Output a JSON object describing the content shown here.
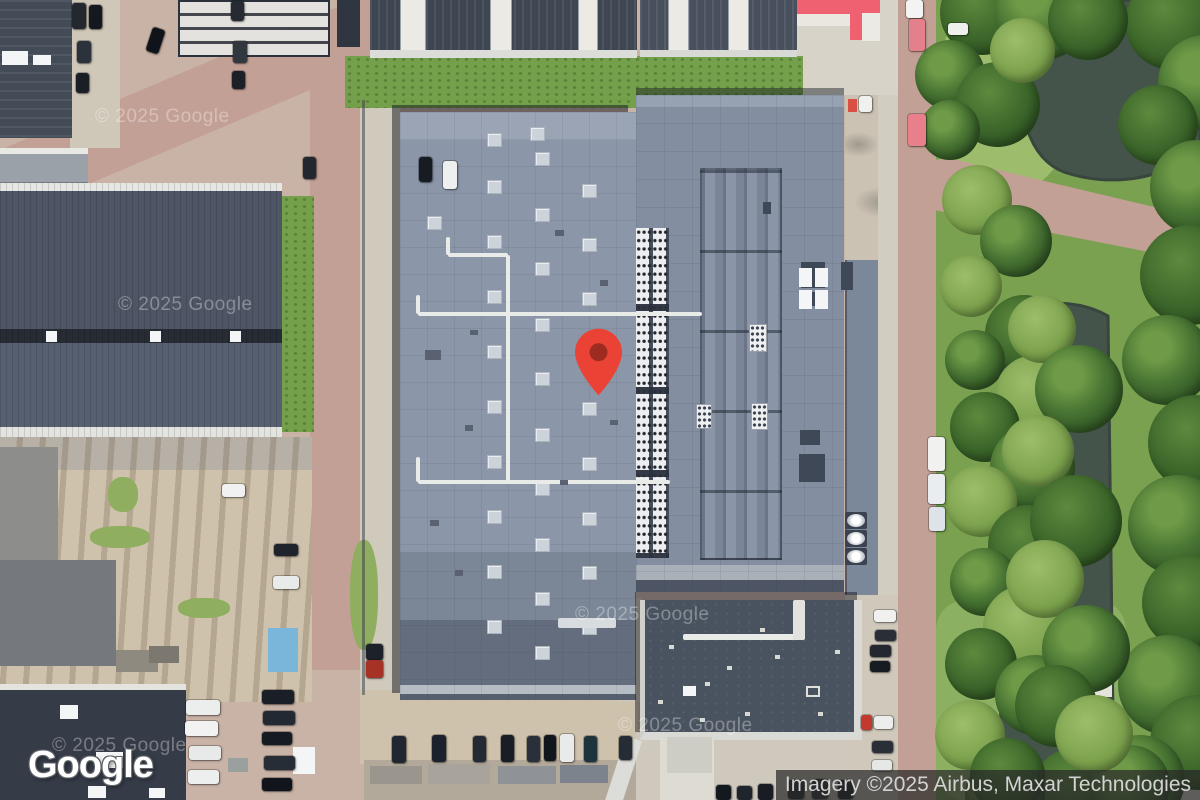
{
  "map": {
    "view": "satellite",
    "logo": "Google",
    "attribution": "Imagery ©2025 Airbus, Maxar Technologies",
    "watermark": "© 2025 Google",
    "watermarks": [
      [
        95,
        106
      ],
      [
        118,
        294
      ],
      [
        575,
        604
      ],
      [
        618,
        715
      ],
      [
        52,
        735
      ]
    ],
    "marker": {
      "name": "location-pin",
      "color": "#EA4335",
      "dot_color": "#9E2B20",
      "x": 598,
      "y": 396
    }
  },
  "colors": {
    "pin_red": "#EA4335",
    "water": "#45544b",
    "grass": "#79a150",
    "road": "#c3a095",
    "main_roof": "#8b96a8",
    "attribution_bg": "rgba(40,40,40,0.72)"
  },
  "scene": {
    "trees": [
      [
        1125,
        -25,
        95,
        1
      ],
      [
        1158,
        35,
        95,
        0
      ],
      [
        1118,
        85,
        80,
        1
      ],
      [
        1150,
        140,
        95,
        0
      ],
      [
        1140,
        225,
        100,
        1
      ],
      [
        1122,
        315,
        90,
        0
      ],
      [
        1148,
        395,
        95,
        1
      ],
      [
        1128,
        475,
        100,
        0
      ],
      [
        1142,
        555,
        95,
        1
      ],
      [
        1118,
        635,
        100,
        0
      ],
      [
        1150,
        695,
        95,
        1
      ],
      [
        1095,
        735,
        90,
        0
      ],
      [
        1032,
        748,
        85,
        1
      ],
      [
        965,
        755,
        80,
        0
      ],
      [
        935,
        700,
        70,
        2
      ],
      [
        970,
        738,
        75,
        1
      ],
      [
        1090,
        745,
        80,
        0
      ],
      [
        940,
        -30,
        85,
        1
      ],
      [
        995,
        -35,
        95,
        0
      ],
      [
        1048,
        -20,
        80,
        1
      ],
      [
        915,
        40,
        70,
        0
      ],
      [
        955,
        62,
        85,
        1
      ],
      [
        920,
        100,
        60,
        0
      ],
      [
        990,
        18,
        65,
        2
      ],
      [
        942,
        165,
        70,
        2
      ],
      [
        980,
        205,
        72,
        0
      ],
      [
        940,
        255,
        62,
        2
      ],
      [
        985,
        295,
        78,
        1
      ],
      [
        945,
        330,
        60,
        0
      ],
      [
        995,
        355,
        80,
        2
      ],
      [
        950,
        392,
        70,
        1
      ],
      [
        990,
        425,
        85,
        0
      ],
      [
        945,
        465,
        72,
        2
      ],
      [
        988,
        505,
        80,
        1
      ],
      [
        950,
        548,
        68,
        0
      ],
      [
        983,
        585,
        85,
        2
      ],
      [
        945,
        628,
        72,
        1
      ],
      [
        995,
        655,
        80,
        0
      ],
      [
        1008,
        295,
        68,
        2
      ],
      [
        1035,
        345,
        88,
        0
      ],
      [
        1002,
        415,
        72,
        2
      ],
      [
        1030,
        475,
        92,
        1
      ],
      [
        1006,
        540,
        78,
        2
      ],
      [
        1042,
        605,
        88,
        0
      ],
      [
        1015,
        665,
        82,
        1
      ],
      [
        1055,
        695,
        78,
        2
      ]
    ],
    "cars": [
      [
        72,
        3,
        14,
        26,
        "#23272e"
      ],
      [
        89,
        5,
        13,
        24,
        "#15181e"
      ],
      [
        77,
        41,
        14,
        22,
        "#2c323b"
      ],
      [
        76,
        73,
        13,
        20,
        "#1a1e25"
      ],
      [
        149,
        28,
        13,
        25,
        "#101319",
        18
      ],
      [
        231,
        1,
        13,
        20,
        "#262b33"
      ],
      [
        233,
        41,
        14,
        22,
        "#31373f"
      ],
      [
        232,
        71,
        13,
        18,
        "#1b2026"
      ],
      [
        303,
        157,
        13,
        22,
        "#23282f"
      ],
      [
        419,
        157,
        13,
        25,
        "#171b22"
      ],
      [
        443,
        161,
        14,
        28,
        "#eef0ef"
      ],
      [
        392,
        736,
        14,
        27,
        "#202730"
      ],
      [
        432,
        735,
        14,
        27,
        "#1c222b"
      ],
      [
        473,
        736,
        13,
        26,
        "#242a34"
      ],
      [
        501,
        735,
        13,
        27,
        "#181d26"
      ],
      [
        527,
        736,
        13,
        26,
        "#2a303a"
      ],
      [
        544,
        735,
        12,
        26,
        "#11151c"
      ],
      [
        560,
        734,
        14,
        28,
        "#e9ebea"
      ],
      [
        584,
        736,
        13,
        26,
        "#1e343c"
      ],
      [
        619,
        736,
        13,
        24,
        "#262c35"
      ],
      [
        186,
        700,
        34,
        15,
        "#eceeed"
      ],
      [
        185,
        721,
        33,
        15,
        "#f1f2f1"
      ],
      [
        189,
        746,
        32,
        14,
        "#e8eaea"
      ],
      [
        188,
        770,
        31,
        14,
        "#edeeee"
      ],
      [
        262,
        690,
        32,
        14,
        "#1a1f27"
      ],
      [
        263,
        711,
        32,
        14,
        "#232933"
      ],
      [
        262,
        732,
        30,
        13,
        "#161a21"
      ],
      [
        264,
        756,
        31,
        14,
        "#272d37"
      ],
      [
        262,
        778,
        30,
        13,
        "#11151b"
      ],
      [
        222,
        484,
        23,
        13,
        "#f0f1f0"
      ],
      [
        274,
        544,
        24,
        12,
        "#1e232c"
      ],
      [
        273,
        576,
        26,
        13,
        "#e9eaea"
      ],
      [
        870,
        645,
        21,
        12,
        "#23272f"
      ],
      [
        870,
        661,
        20,
        11,
        "#171b22"
      ],
      [
        861,
        715,
        11,
        15,
        "#c2392d"
      ],
      [
        874,
        716,
        19,
        13,
        "#ecedec"
      ],
      [
        872,
        741,
        21,
        12,
        "#2a2f37"
      ],
      [
        872,
        760,
        20,
        11,
        "#e6e8e7"
      ],
      [
        874,
        610,
        22,
        12,
        "#f0f1ef"
      ],
      [
        875,
        630,
        21,
        11,
        "#292e37"
      ],
      [
        906,
        0,
        17,
        18,
        "#f2f3f2"
      ],
      [
        909,
        19,
        16,
        32,
        "#e4808c"
      ],
      [
        908,
        114,
        18,
        32,
        "#e87f8b"
      ],
      [
        948,
        23,
        20,
        12,
        "#eff0ee"
      ],
      [
        928,
        437,
        17,
        34,
        "#f1f2f0"
      ],
      [
        928,
        474,
        17,
        30,
        "#e9edf0"
      ],
      [
        929,
        507,
        16,
        24,
        "#dde3e8"
      ],
      [
        859,
        96,
        13,
        16,
        "#f0f1ef"
      ],
      [
        716,
        785,
        15,
        15,
        "#14181f"
      ],
      [
        737,
        786,
        15,
        14,
        "#20252d"
      ],
      [
        758,
        784,
        15,
        16,
        "#181c24"
      ],
      [
        788,
        780,
        16,
        19,
        "#1d222a"
      ],
      [
        812,
        779,
        16,
        20,
        "#252b34"
      ],
      [
        838,
        780,
        15,
        19,
        "#14181f"
      ],
      [
        366,
        644,
        17,
        16,
        "#1d222a"
      ],
      [
        366,
        660,
        17,
        18,
        "#a63226"
      ]
    ],
    "skylights": [
      [
        487,
        133
      ],
      [
        530,
        127
      ],
      [
        535,
        152
      ],
      [
        487,
        180
      ],
      [
        582,
        184
      ],
      [
        535,
        208
      ],
      [
        427,
        216
      ],
      [
        487,
        235
      ],
      [
        582,
        238
      ],
      [
        535,
        262
      ],
      [
        487,
        290
      ],
      [
        582,
        292
      ],
      [
        535,
        318
      ],
      [
        487,
        345
      ],
      [
        582,
        347
      ],
      [
        535,
        372
      ],
      [
        487,
        400
      ],
      [
        582,
        402
      ],
      [
        535,
        428
      ],
      [
        487,
        455
      ],
      [
        582,
        457
      ],
      [
        535,
        482
      ],
      [
        487,
        510
      ],
      [
        582,
        512
      ],
      [
        535,
        538
      ],
      [
        487,
        565
      ],
      [
        582,
        566
      ],
      [
        535,
        592
      ],
      [
        487,
        620
      ],
      [
        582,
        621
      ],
      [
        535,
        646
      ]
    ],
    "sprites": [
      [
        "pipe",
        418,
        312,
        284,
        4
      ],
      [
        "pipe",
        506,
        255,
        4,
        60
      ],
      [
        "pipe",
        448,
        253,
        60,
        4
      ],
      [
        "pipe",
        446,
        237,
        4,
        18
      ],
      [
        "pipe",
        418,
        480,
        252,
        4
      ],
      [
        "pipe",
        506,
        314,
        4,
        168
      ],
      [
        "pipe",
        416,
        295,
        4,
        19
      ],
      [
        "pipe",
        416,
        457,
        4,
        25
      ],
      [
        "pipe",
        558,
        618,
        58,
        10,
        "#d9dcdf"
      ],
      [
        "pipe",
        683,
        634,
        114,
        6
      ],
      [
        "pipe",
        793,
        600,
        12,
        40,
        "#e2e3df"
      ],
      [
        "panel",
        801,
        262,
        24,
        26
      ],
      [
        "panel",
        801,
        292,
        24,
        14
      ],
      [
        "panel",
        799,
        454,
        26,
        28
      ],
      [
        "panel",
        841,
        262,
        12,
        28
      ],
      [
        "panel",
        800,
        430,
        20,
        15
      ],
      [
        "panel",
        763,
        202,
        8,
        12
      ],
      [
        "hvacbox",
        749,
        324,
        18,
        28
      ],
      [
        "hvacbox",
        696,
        404,
        16,
        25
      ],
      [
        "hvacbox",
        751,
        403,
        17,
        27
      ],
      [
        "fan",
        845,
        512,
        22,
        17
      ],
      [
        "fan",
        845,
        530,
        22,
        17
      ],
      [
        "fan",
        845,
        548,
        22,
        17
      ],
      [
        "slb",
        799,
        268,
        13,
        19
      ],
      [
        "slb",
        815,
        268,
        13,
        19
      ],
      [
        "slb",
        799,
        290,
        13,
        19
      ],
      [
        "slb",
        815,
        290,
        13,
        19
      ],
      [
        "slb",
        46,
        331,
        11,
        11
      ],
      [
        "slb",
        150,
        331,
        11,
        11
      ],
      [
        "slb",
        230,
        331,
        11,
        11
      ],
      [
        "slb",
        60,
        705,
        18,
        14
      ],
      [
        "slb",
        96,
        752,
        27,
        16
      ],
      [
        "slb",
        88,
        786,
        18,
        12
      ],
      [
        "slb",
        149,
        788,
        16,
        10
      ],
      [
        "slb",
        293,
        747,
        22,
        27
      ],
      [
        "slb",
        2,
        51,
        26,
        14
      ],
      [
        "slb",
        33,
        55,
        18,
        10
      ],
      [
        "rstrip",
        400,
        0,
        26,
        50
      ],
      [
        "rstrip",
        490,
        0,
        22,
        50
      ],
      [
        "rstrip",
        578,
        0,
        20,
        50
      ],
      [
        "rstrip",
        668,
        0,
        21,
        50
      ],
      [
        "rstrip",
        728,
        0,
        21,
        50
      ],
      [
        "box",
        797,
        0,
        83,
        14,
        "#ef6071"
      ],
      [
        "box",
        850,
        13,
        12,
        27,
        "#ef6071"
      ],
      [
        "box",
        862,
        13,
        18,
        28,
        "#eceae4"
      ],
      [
        "box",
        797,
        14,
        53,
        12,
        "#e9e7e0"
      ],
      [
        "box",
        848,
        99,
        9,
        13,
        "#d94f44"
      ],
      [
        "box",
        268,
        628,
        30,
        44,
        "#7ab6d9"
      ],
      [
        "outline",
        806,
        686,
        14,
        11
      ],
      [
        "slb",
        683,
        686,
        13,
        10
      ],
      [
        "box",
        615,
        737,
        17,
        68,
        "#dcddd9",
        18
      ],
      [
        "box",
        667,
        737,
        45,
        36,
        "#cdcdc6"
      ],
      [
        "box",
        1085,
        650,
        27,
        47,
        "#e5e3db"
      ],
      [
        "box",
        116,
        650,
        42,
        22,
        "#8e8a80"
      ],
      [
        "box",
        149,
        646,
        30,
        17,
        "#7c7870"
      ],
      [
        "grasspatch",
        90,
        526,
        60,
        22
      ],
      [
        "grasspatch",
        108,
        477,
        30,
        35
      ],
      [
        "grasspatch",
        178,
        598,
        52,
        20
      ],
      [
        "grasspatch",
        350,
        540,
        28,
        110
      ],
      [
        "dotw",
        669,
        645,
        5,
        4
      ],
      [
        "dotw",
        705,
        682,
        5,
        4
      ],
      [
        "dotw",
        745,
        712,
        5,
        4
      ],
      [
        "dotw",
        775,
        655,
        5,
        4
      ],
      [
        "dotw",
        700,
        718,
        5,
        4
      ],
      [
        "dotw",
        727,
        666,
        5,
        4
      ],
      [
        "dotw",
        658,
        700,
        5,
        4
      ],
      [
        "dotw",
        818,
        712,
        5,
        4
      ],
      [
        "dotw",
        835,
        650,
        5,
        4
      ],
      [
        "dotw",
        760,
        628,
        5,
        4
      ],
      [
        "dotd",
        448,
        180,
        8,
        6
      ],
      [
        "dotd",
        555,
        230,
        9,
        6
      ],
      [
        "dotd",
        470,
        330,
        8,
        5
      ],
      [
        "dotd",
        600,
        280,
        8,
        6
      ],
      [
        "dotd",
        430,
        520,
        9,
        6
      ],
      [
        "dotd",
        560,
        480,
        8,
        5
      ],
      [
        "dotd",
        455,
        570,
        8,
        6
      ],
      [
        "dotd",
        610,
        420,
        8,
        5
      ],
      [
        "dotd",
        425,
        350,
        16,
        10
      ],
      [
        "dotd",
        465,
        425,
        8,
        6
      ],
      [
        "box",
        362,
        100,
        3,
        595,
        "#3f454d",
        0,
        0.55
      ],
      [
        "box",
        228,
        758,
        20,
        14,
        "#9aa09e"
      ],
      [
        "box",
        370,
        766,
        52,
        18,
        "#9b968d"
      ],
      [
        "box",
        428,
        764,
        62,
        20,
        "#a8a49c"
      ],
      [
        "box",
        498,
        766,
        58,
        18,
        "#8f9398"
      ],
      [
        "box",
        560,
        765,
        48,
        18,
        "#7d838c"
      ]
    ]
  }
}
